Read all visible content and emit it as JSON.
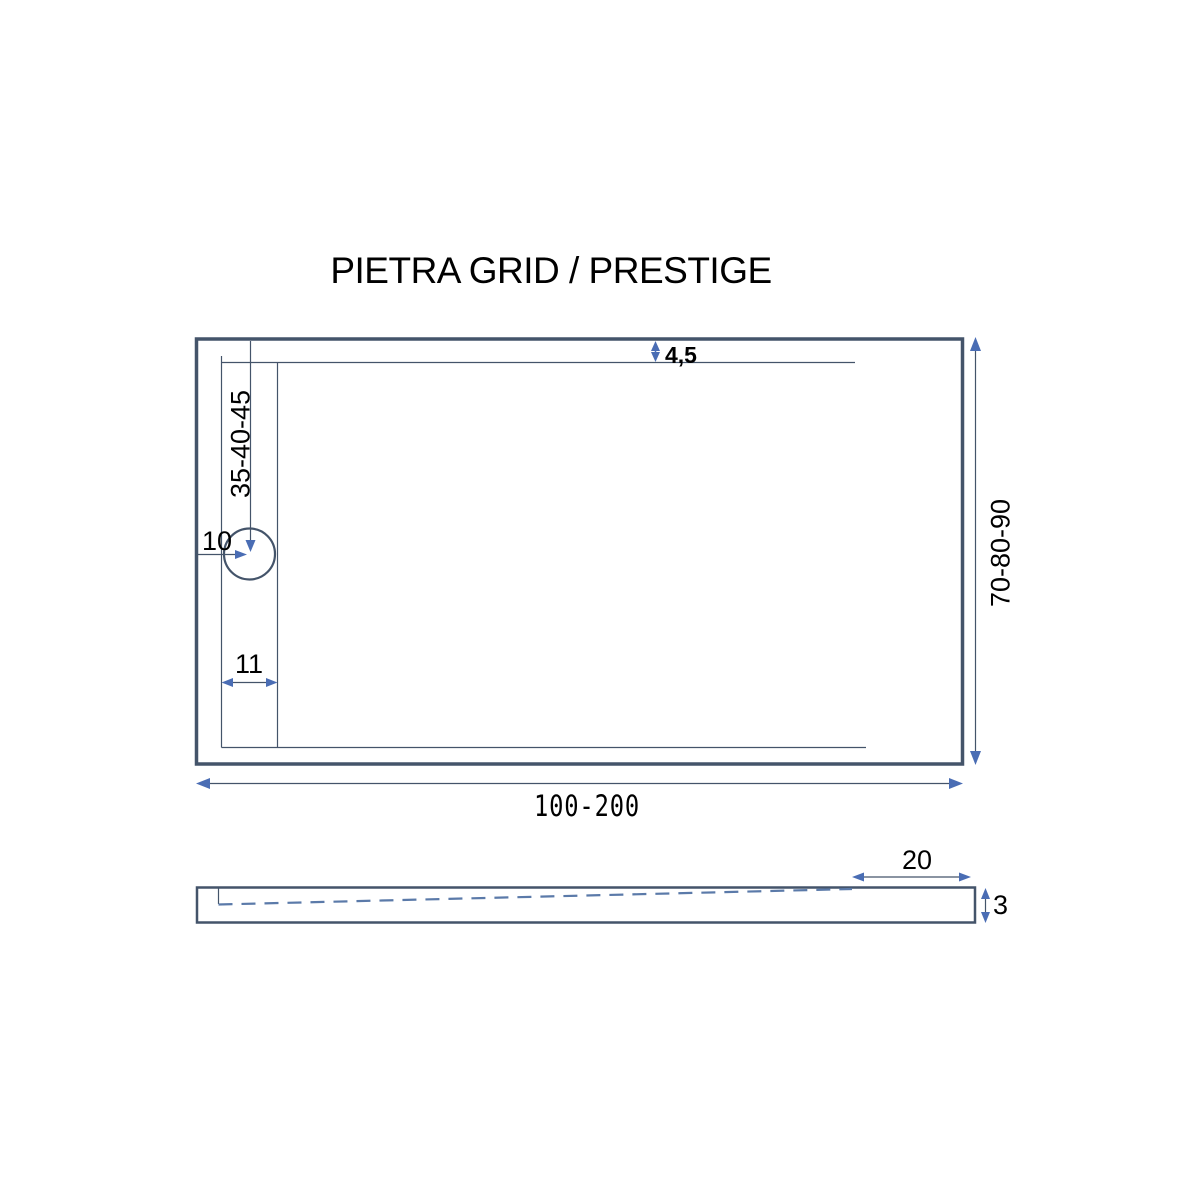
{
  "title": "PIETRA GRID / PRESTIGE",
  "colors": {
    "line": "#44546A",
    "arrow_head": "#4A6DB4",
    "arrow_shaft_blue": "#4472C4",
    "slope_dash": "#5B7AA9",
    "text": "#000000",
    "background": "#FFFFFF"
  },
  "top_view": {
    "description": "shower tray plan view",
    "labels": {
      "rim_offset": "4,5",
      "drain_center_distance": "35-40-45",
      "drain_diameter": "10",
      "drain_strip_width": "11",
      "width_range": "70-80-90",
      "length_range": "100-200"
    }
  },
  "side_view": {
    "description": "shower tray side profile with slope",
    "labels": {
      "flat_end_length": "20",
      "edge_thickness": "3"
    }
  }
}
